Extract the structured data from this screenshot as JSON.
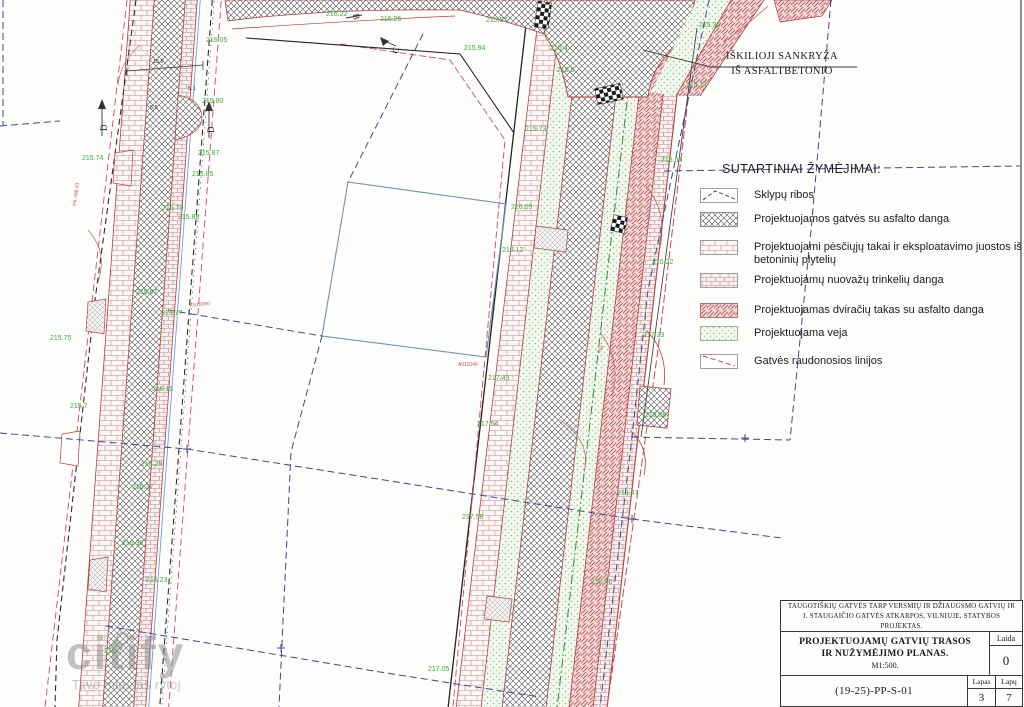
{
  "legend": {
    "title": "SUTARTINIAI ŽYMĖJIMAI:",
    "items": [
      {
        "swatch": "parcel-boundary",
        "label": "Sklypų ribos"
      },
      {
        "swatch": "asphalt-street-crosshatch",
        "label": "Projektuojamos gatvės su asfalto danga"
      },
      {
        "swatch": "concrete-tile-walkway",
        "label": "Projektuojami pėsčiųjų takai ir eksploatavimo juostos iš betoninių plytelių"
      },
      {
        "swatch": "driveway-pavers",
        "label": "Projektuojamų nuovažų trinkelių danga"
      },
      {
        "swatch": "bike-path-red-hatch",
        "label": "Projektuojamas dviračių takas su asfalto danga"
      },
      {
        "swatch": "lawn-green-dots",
        "label": "Projektuojama veja"
      },
      {
        "swatch": "street-red-lines",
        "label": "Gatvės raudonosios linijos"
      }
    ]
  },
  "callout": {
    "line1": "IŠKILIOJI SANKRYŽA",
    "line2": "IŠ ASFALTBETONIO"
  },
  "title_block": {
    "project": "TAUGOTIŠKIŲ GATVĖS TARP VERSMIŲ IR DŽIAUGSMO GATVIŲ IR J. STAUGAIČIO GATVĖS ATKARPOS, VILNIUJE, STATYBOS PROJEKTAS.",
    "drawing_title_line1": "PROJEKTUOJAMŲ GATVIŲ TRASOS",
    "drawing_title_line2": "IR NUŽYMĖJIMO PLANAS.",
    "scale": "M1:500.",
    "laida_label": "Laida",
    "laida_value": "0",
    "doc_number": "(19-25)-PP-S-01",
    "lapas_label": "Lapas",
    "lapas_value": "3",
    "lapu_label": "Lapų",
    "lapu_value": "7"
  },
  "watermark": {
    "name": "citify",
    "tagline": "Tavo miestas rytoj"
  },
  "plan": {
    "section_markers": [
      {
        "label": "C"
      },
      {
        "label": "D"
      },
      {
        "label": "D"
      },
      {
        "label": "B"
      }
    ],
    "elevation_labels": [
      {
        "t": "216.05",
        "x": 206,
        "y": 42
      },
      {
        "t": "215.80",
        "x": 202,
        "y": 103
      },
      {
        "t": "215.74",
        "x": 82,
        "y": 160
      },
      {
        "t": "215.87",
        "x": 198,
        "y": 155
      },
      {
        "t": "215.85",
        "x": 192,
        "y": 176
      },
      {
        "t": "215.79",
        "x": 162,
        "y": 210
      },
      {
        "t": "215.88",
        "x": 178,
        "y": 219
      },
      {
        "t": "215.67",
        "x": 136,
        "y": 294
      },
      {
        "t": "215.77",
        "x": 161,
        "y": 315
      },
      {
        "t": "215.75",
        "x": 50,
        "y": 340
      },
      {
        "t": "216.11",
        "x": 152,
        "y": 391
      },
      {
        "t": "215.7",
        "x": 70,
        "y": 408
      },
      {
        "t": "216.29",
        "x": 141,
        "y": 466
      },
      {
        "t": "216.37",
        "x": 132,
        "y": 489
      },
      {
        "t": "216.30",
        "x": 122,
        "y": 545
      },
      {
        "t": "216.23",
        "x": 146,
        "y": 582
      },
      {
        "t": "216.2",
        "x": 104,
        "y": 653
      },
      {
        "t": "217.05",
        "x": 428,
        "y": 671
      },
      {
        "t": "216.22",
        "x": 326,
        "y": 16
      },
      {
        "t": "216.26",
        "x": 380,
        "y": 21
      },
      {
        "t": "215.97",
        "x": 486,
        "y": 22
      },
      {
        "t": "215.94",
        "x": 464,
        "y": 50
      },
      {
        "t": "215.73",
        "x": 525,
        "y": 131
      },
      {
        "t": "215.30",
        "x": 699,
        "y": 27
      },
      {
        "t": "215.17",
        "x": 686,
        "y": 87
      },
      {
        "t": "215.4",
        "x": 550,
        "y": 50
      },
      {
        "t": "215.5",
        "x": 557,
        "y": 72
      },
      {
        "t": "215.65",
        "x": 661,
        "y": 162
      },
      {
        "t": "216.22",
        "x": 652,
        "y": 264
      },
      {
        "t": "216.09",
        "x": 511,
        "y": 209
      },
      {
        "t": "216.12",
        "x": 502,
        "y": 252
      },
      {
        "t": "217.23",
        "x": 643,
        "y": 337
      },
      {
        "t": "218.08",
        "x": 645,
        "y": 417
      },
      {
        "t": "217.49",
        "x": 488,
        "y": 380
      },
      {
        "t": "217.54",
        "x": 477,
        "y": 426
      },
      {
        "t": "218.47",
        "x": 617,
        "y": 495
      },
      {
        "t": "217.58",
        "x": 462,
        "y": 519
      },
      {
        "t": "218.40",
        "x": 591,
        "y": 584
      }
    ],
    "dimension_labels": [
      {
        "t": "15,0",
        "x": 153,
        "y": 63
      },
      {
        "t": "5,1",
        "x": 188,
        "y": 90
      },
      {
        "t": "5,5",
        "x": 150,
        "y": 109
      }
    ],
    "station_labels": [
      {
        "t": "A511046",
        "x": 458,
        "y": 366,
        "r": 0
      },
      {
        "t": "K510090",
        "x": 190,
        "y": 307,
        "r": -6
      },
      {
        "t": "PK 496,43",
        "x": 76,
        "y": 206,
        "r": -83
      },
      {
        "t": "RNr",
        "x": 600,
        "y": 354,
        "r": -62
      }
    ]
  },
  "colors": {
    "elevation_green": "#3aab3a",
    "red_line": "#b04040",
    "red_dashed": "#c84a6a",
    "parcel_dashed_blue": "#3c4a86",
    "survey_teal": "#7292b0",
    "bike_hatch_fill": "#f2dada",
    "lawn_fill": "#f4f9f0"
  }
}
